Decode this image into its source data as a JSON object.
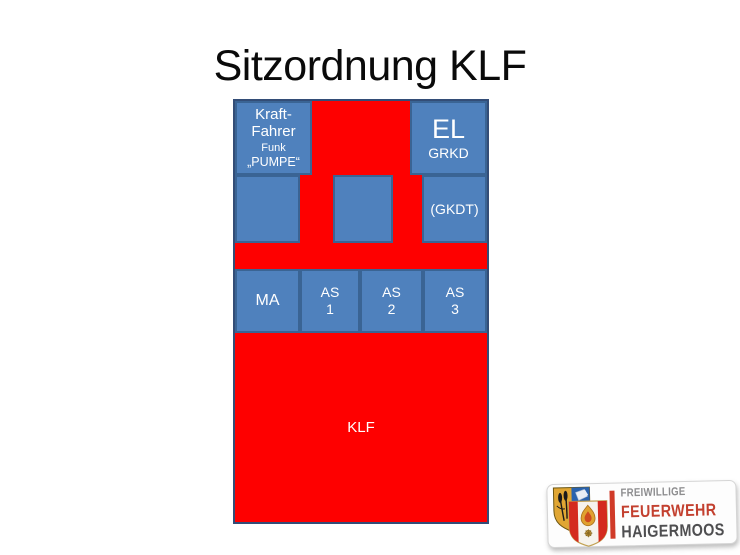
{
  "slide": {
    "title": "Sitzordnung KLF"
  },
  "diagram": {
    "colors": {
      "seat_fill": "#4f81bd",
      "seat_border": "#3a6494",
      "aisle_red": "#fe0000",
      "frame_border": "#334d77",
      "seat_text": "#ffffff"
    },
    "seats": {
      "driver": {
        "line1": "Kraft-",
        "line2": "Fahrer",
        "line3": "Funk",
        "line4": "„PUMPE“"
      },
      "el": {
        "line1": "EL",
        "line2": "GRKD"
      },
      "gkdt": {
        "label": "(GKDT)"
      },
      "ma": {
        "label": "MA"
      },
      "as1": {
        "line1": "AS",
        "line2": "1"
      },
      "as2": {
        "line1": "AS",
        "line2": "2"
      },
      "as3": {
        "line1": "AS",
        "line2": "3"
      }
    },
    "vehicle_label": "KLF"
  },
  "logo": {
    "line1": "FREIWILLIGE",
    "line2": "FEUERWEHR",
    "line3": "HAIGERMOOS",
    "colors": {
      "line1_gray": "#8d8d8f",
      "line2_red": "#c3402f",
      "line3_dark": "#4e4e50",
      "bar_red": "#d03a28",
      "shield_gold": "#e0a633",
      "shield_blue": "#2a63ae",
      "shield_stripe_red": "#d42b1e"
    }
  }
}
